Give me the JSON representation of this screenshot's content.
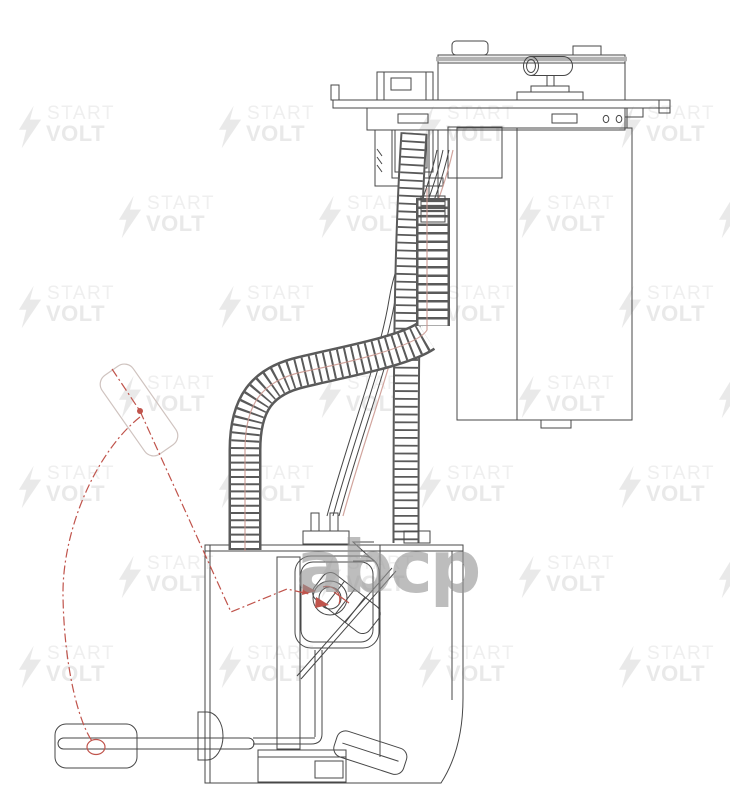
{
  "center_logo": {
    "text": "abcp"
  },
  "watermark": {
    "line1": "START",
    "line2": "VOLT",
    "icon": "lightning-bolt-icon",
    "rows": 7,
    "cols": 4,
    "first_row_y": 104,
    "row_spacing": 90,
    "even_row_x": 18,
    "odd_row_x": 118,
    "col_spacing": 200
  },
  "colors": {
    "paper": "#ffffff",
    "line": "#474747",
    "line_soft": "#5a5a5a",
    "watermark": "#e9e9e9",
    "watermark_light": "#efefef",
    "logo": "rgba(148,148,148,0.62)",
    "accent_red": "#c0544c",
    "accent_red_soft": "#c9948c",
    "ghost_outline": "#cfc3bf",
    "cover_bar": "#b3b3b3"
  },
  "drawing": {
    "subject": "fuel-pump-module-technical-drawing"
  }
}
